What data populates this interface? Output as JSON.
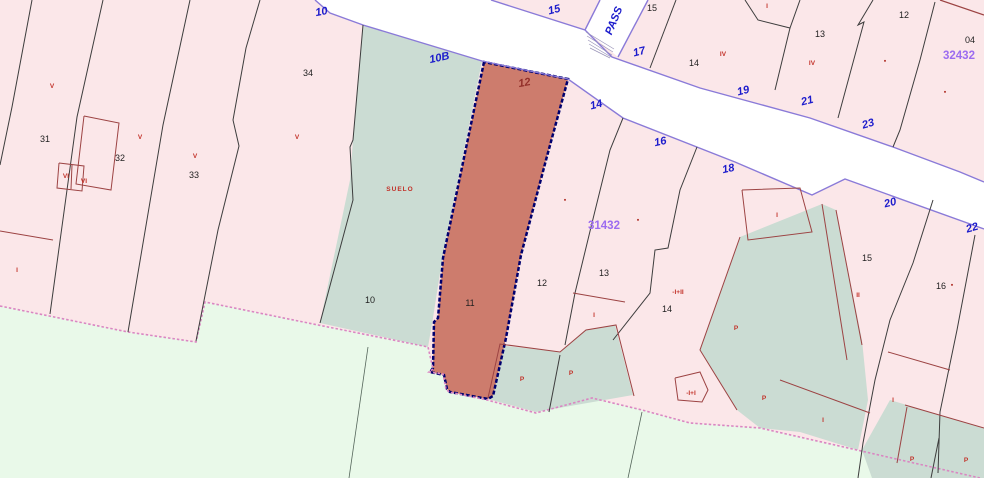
{
  "colors": {
    "pink": "#fbe7e9",
    "rural": "#e9f9e9",
    "teal": "#cbdcd3",
    "street": "#ffffff",
    "selected": "#cd7c6d",
    "navy": "#00006e",
    "violet": "#8a7ad8",
    "blackline": "#3d3d3d",
    "redline": "#9c4343",
    "urbanedge": "#da86c2",
    "stairs": "#9a94b8",
    "ruralline": "#54655a"
  },
  "map": {
    "width": 984,
    "height": 478,
    "polygons": [
      {
        "name": "urban-base",
        "fill": "pink",
        "points": "0,0 984,0 984,478 0,478"
      },
      {
        "name": "rural-land",
        "fill": "rural",
        "points": "0,306 128,332 196,342 205,302 318,325 428,347 433,369 429,372 443,374 446,389 449,392 487,400 536,413 592,398 642,410 690,423 760,428 980,478 0,478"
      },
      {
        "name": "parcel-10-suelo",
        "fill": "teal",
        "points": "363,25 482,61 442,260 433,318 428,347 320,323 350,180 356,100"
      },
      {
        "name": "patio-left",
        "fill": "teal",
        "points": "498,345 560,352 585,330 615,325 633,395 536,412 488,399"
      },
      {
        "name": "patio-14",
        "fill": "teal",
        "points": "740,237 822,204 836,210 862,340 868,400 858,450 800,432 760,428 737,410 700,350"
      },
      {
        "name": "patio-right",
        "fill": "teal",
        "points": "890,400 984,428 984,478 872,478 862,450"
      },
      {
        "name": "street-main",
        "fill": "street",
        "points": "315,0 491,0 585,30 612,57 700,88 810,118 893,147 960,172 984,182 984,229 845,179 812,195 735,162 623,118 568,79 482,61 363,25 330,13"
      },
      {
        "name": "street-passage",
        "fill": "street",
        "points": "600,0 648,0 618,57 585,30"
      },
      {
        "name": "parcel-11-selected",
        "fill": "selected",
        "stroke": "navy",
        "sw": 2.5,
        "dash": "4,2",
        "points": "484,62 443,258 438,318 434,322 433,368 430,372 444,375 447,389 450,392 488,399 493,396 506,338 521,255 546,160 568,79"
      }
    ],
    "lines": [
      {
        "name": "street-border-lower",
        "stroke": "violet",
        "sw": 1.4,
        "points": "315,0 330,13 363,25 482,61 568,79 623,118 735,162 812,195 845,179 984,229"
      },
      {
        "name": "street-border-upper",
        "stroke": "violet",
        "sw": 1.4,
        "points": "491,0 585,30 612,57 700,88 810,118 893,147 960,172 984,182"
      },
      {
        "name": "passage-border-left",
        "stroke": "violet",
        "sw": 1.4,
        "points": "600,0 585,30"
      },
      {
        "name": "passage-border-right",
        "stroke": "violet",
        "sw": 1.4,
        "points": "648,0 618,57"
      },
      {
        "name": "urban-edge",
        "stroke": "urbanedge",
        "sw": 1.6,
        "dash": "2.5,2",
        "points": "0,306 128,332 196,342 205,302 318,325 428,347 433,369 429,372 443,374 446,389 449,392 487,400 536,413 592,398 642,410 690,423 760,428 980,478"
      },
      {
        "name": "parcel-line-31",
        "stroke": "blackline",
        "sw": 1,
        "points": "32,0 12,107 0,165"
      },
      {
        "name": "parcel-line-31-32",
        "stroke": "blackline",
        "sw": 1,
        "points": "103,0 77,117 50,314"
      },
      {
        "name": "parcel-line-32-33",
        "stroke": "blackline",
        "sw": 1,
        "points": "190,0 163,125 128,332"
      },
      {
        "name": "parcel-line-33-34",
        "stroke": "blackline",
        "sw": 1,
        "points": "260,0 246,48 233,120 239,146 218,230 196,341"
      },
      {
        "name": "parcel-line-34-10",
        "stroke": "blackline",
        "sw": 1,
        "points": "363,25 353,140 350,147 353,200 320,323"
      },
      {
        "name": "parcel-line-12-13",
        "stroke": "blackline",
        "sw": 1,
        "points": "623,118 610,150 592,223 575,293 565,345"
      },
      {
        "name": "parcel-line-13-14",
        "stroke": "blackline",
        "sw": 1,
        "points": "697,147 680,190 668,248 655,250 650,293 613,340"
      },
      {
        "name": "patio-divider",
        "stroke": "blackline",
        "sw": 1,
        "points": "560,355 549,412"
      },
      {
        "name": "upper-parcel-line-15-17",
        "stroke": "blackline",
        "sw": 1,
        "points": "676,0 650,68"
      },
      {
        "name": "upper-parcel-small-i",
        "stroke": "blackline",
        "sw": 1,
        "points": "745,0 758,20 790,28 800,0"
      },
      {
        "name": "upper-parcel-line-14-13",
        "stroke": "blackline",
        "sw": 1,
        "points": "790,28 775,90"
      },
      {
        "name": "upper-parcel-line-13-12",
        "stroke": "blackline",
        "sw": 1,
        "points": "873,0 858,25 864,22 838,118"
      },
      {
        "name": "upper-parcel-line-12-04",
        "stroke": "blackline",
        "sw": 1,
        "points": "935,2 920,60 900,130 893,147"
      },
      {
        "name": "right-parcel-line-15-16",
        "stroke": "blackline",
        "sw": 1,
        "points": "933,200 913,263 890,320 875,380 863,443 858,478"
      },
      {
        "name": "right-parcel-line-16-e",
        "stroke": "blackline",
        "sw": 1,
        "points": "975,235 957,330 940,412 938,473"
      },
      {
        "name": "right-patio-divider",
        "stroke": "blackline",
        "sw": 1,
        "points": "939,438 931,478"
      },
      {
        "name": "rural-line-1",
        "stroke": "ruralline",
        "sw": 0.8,
        "points": "368,347 349,478"
      },
      {
        "name": "rural-line-2",
        "stroke": "ruralline",
        "sw": 0.8,
        "points": "642,412 628,478"
      },
      {
        "name": "building-edge-left",
        "stroke": "redline",
        "sw": 1,
        "points": "0,231 53,240"
      },
      {
        "name": "building-32-outline",
        "stroke": "redline",
        "sw": 1,
        "points": "84,116 119,123 111,190 76,184 84,116"
      },
      {
        "name": "building-32-annex",
        "stroke": "redline",
        "sw": 1,
        "points": "59,163 84,166 82,191 57,188 59,163"
      },
      {
        "name": "building-32-annex-div",
        "stroke": "redline",
        "sw": 1,
        "points": "72,165 71,189"
      },
      {
        "name": "building-line-13-i",
        "stroke": "redline",
        "sw": 1,
        "points": "573,293 625,302"
      },
      {
        "name": "building-i-i-outline",
        "stroke": "redline",
        "sw": 1,
        "points": "675,378 700,372 708,390 702,402 678,400 675,378"
      },
      {
        "name": "patio-14-border",
        "stroke": "redline",
        "sw": 1,
        "points": "740,237 700,350 737,410"
      },
      {
        "name": "strip-border-left",
        "stroke": "redline",
        "sw": 1,
        "points": "822,204 847,360"
      },
      {
        "name": "strip-border-right",
        "stroke": "redline",
        "sw": 1,
        "points": "836,210 862,345"
      },
      {
        "name": "building-i-strip-outline",
        "stroke": "redline",
        "sw": 1,
        "points": "742,190 800,188 812,232 748,240 742,190"
      },
      {
        "name": "building-line-right-1",
        "stroke": "redline",
        "sw": 1,
        "points": "780,380 870,413"
      },
      {
        "name": "building-line-right-2",
        "stroke": "redline",
        "sw": 1,
        "points": "888,352 950,370"
      },
      {
        "name": "right-patio-border",
        "stroke": "redline",
        "sw": 1,
        "points": "905,405 984,428"
      },
      {
        "name": "right-patio-border-2",
        "stroke": "redline",
        "sw": 1,
        "points": "907,407 897,463"
      },
      {
        "name": "patio-left-border",
        "stroke": "redline",
        "sw": 1,
        "points": "488,398 500,344 560,352 586,330 616,325 634,396"
      },
      {
        "name": "building-corner-topright",
        "stroke": "redline",
        "sw": 1.2,
        "points": "940,0 984,15"
      },
      {
        "name": "stair-1",
        "stroke": "stairs",
        "sw": 0.7,
        "points": "586,32 614,49"
      },
      {
        "name": "stair-2",
        "stroke": "stairs",
        "sw": 0.7,
        "points": "587,36 613,52"
      },
      {
        "name": "stair-3",
        "stroke": "stairs",
        "sw": 0.7,
        "points": "588,40 612,55"
      },
      {
        "name": "stair-4",
        "stroke": "stairs",
        "sw": 0.7,
        "points": "589,44 611,57"
      },
      {
        "name": "stair-5",
        "stroke": "stairs",
        "sw": 0.7,
        "points": "590,48 610,58"
      }
    ],
    "labels": [
      {
        "text": "10",
        "x": 322,
        "y": 15,
        "cls": "lbl-blue",
        "rot": -10,
        "name": "street-number-10"
      },
      {
        "text": "15",
        "x": 555,
        "y": 13,
        "cls": "lbl-blue",
        "rot": -14,
        "name": "street-number-15"
      },
      {
        "text": "10B",
        "x": 440,
        "y": 61,
        "cls": "lbl-blue",
        "rot": -12,
        "name": "street-number-10b"
      },
      {
        "text": "14",
        "x": 597,
        "y": 108,
        "cls": "lbl-blue",
        "rot": -14,
        "name": "street-number-14"
      },
      {
        "text": "17",
        "x": 640,
        "y": 55,
        "cls": "lbl-blue",
        "rot": -14,
        "name": "street-number-17"
      },
      {
        "text": "16",
        "x": 661,
        "y": 145,
        "cls": "lbl-blue",
        "rot": -12,
        "name": "street-number-16"
      },
      {
        "text": "18",
        "x": 729,
        "y": 172,
        "cls": "lbl-blue",
        "rot": -12,
        "name": "street-number-18"
      },
      {
        "text": "19",
        "x": 744,
        "y": 94,
        "cls": "lbl-blue",
        "rot": -14,
        "name": "street-number-19"
      },
      {
        "text": "21",
        "x": 808,
        "y": 104,
        "cls": "lbl-blue",
        "rot": -14,
        "name": "street-number-21"
      },
      {
        "text": "23",
        "x": 869,
        "y": 127,
        "cls": "lbl-blue",
        "rot": -16,
        "name": "street-number-23"
      },
      {
        "text": "20",
        "x": 891,
        "y": 206,
        "cls": "lbl-blue",
        "rot": -14,
        "name": "street-number-20"
      },
      {
        "text": "22",
        "x": 973,
        "y": 231,
        "cls": "lbl-blue",
        "rot": -16,
        "name": "street-number-22"
      },
      {
        "text": "PASS",
        "x": 617,
        "y": 22,
        "cls": "lbl-blue",
        "rot": -68,
        "name": "street-name-pass"
      },
      {
        "text": "12",
        "x": 525,
        "y": 86,
        "cls": "lbl-maroon",
        "rot": -10,
        "name": "street-number-12-selected"
      },
      {
        "text": "31",
        "x": 45,
        "y": 142,
        "cls": "lbl-black",
        "name": "parcel-number-31"
      },
      {
        "text": "32",
        "x": 120,
        "y": 161,
        "cls": "lbl-black",
        "name": "parcel-number-32"
      },
      {
        "text": "33",
        "x": 194,
        "y": 178,
        "cls": "lbl-black",
        "name": "parcel-number-33"
      },
      {
        "text": "34",
        "x": 308,
        "y": 76,
        "cls": "lbl-black",
        "name": "parcel-number-34"
      },
      {
        "text": "10",
        "x": 370,
        "y": 303,
        "cls": "lbl-black",
        "name": "parcel-number-10"
      },
      {
        "text": "11",
        "x": 470,
        "y": 306,
        "cls": "lbl-black",
        "name": "parcel-number-11"
      },
      {
        "text": "12",
        "x": 542,
        "y": 286,
        "cls": "lbl-black",
        "name": "parcel-number-12"
      },
      {
        "text": "13",
        "x": 604,
        "y": 276,
        "cls": "lbl-black",
        "name": "parcel-number-13"
      },
      {
        "text": "14",
        "x": 667,
        "y": 312,
        "cls": "lbl-black",
        "name": "parcel-number-14"
      },
      {
        "text": "15",
        "x": 652,
        "y": 11,
        "cls": "lbl-black",
        "name": "parcel-number-15-upper"
      },
      {
        "text": "14",
        "x": 694,
        "y": 66,
        "cls": "lbl-black",
        "name": "parcel-number-14-upper"
      },
      {
        "text": "13",
        "x": 820,
        "y": 37,
        "cls": "lbl-black",
        "name": "parcel-number-13-upper"
      },
      {
        "text": "12",
        "x": 904,
        "y": 18,
        "cls": "lbl-black",
        "name": "parcel-number-12-upper"
      },
      {
        "text": "04",
        "x": 970,
        "y": 43,
        "cls": "lbl-black",
        "name": "parcel-number-04"
      },
      {
        "text": "15",
        "x": 867,
        "y": 261,
        "cls": "lbl-black",
        "name": "parcel-number-15-right"
      },
      {
        "text": "16",
        "x": 941,
        "y": 289,
        "cls": "lbl-black",
        "name": "parcel-number-16-right"
      },
      {
        "text": "31432",
        "x": 604,
        "y": 229,
        "cls": "lbl-purple",
        "name": "block-number-31432"
      },
      {
        "text": "32432",
        "x": 959,
        "y": 59,
        "cls": "lbl-purple",
        "name": "block-number-32432"
      },
      {
        "text": "V",
        "x": 52,
        "y": 88,
        "cls": "lbl-red",
        "name": "floors-v-1"
      },
      {
        "text": "V",
        "x": 140,
        "y": 139,
        "cls": "lbl-red",
        "name": "floors-v-2"
      },
      {
        "text": "V",
        "x": 195,
        "y": 158,
        "cls": "lbl-red",
        "name": "floors-v-3"
      },
      {
        "text": "V",
        "x": 297,
        "y": 139,
        "cls": "lbl-red",
        "name": "floors-v-4"
      },
      {
        "text": "VI",
        "x": 66,
        "y": 178,
        "cls": "lbl-red",
        "name": "floors-vi-1"
      },
      {
        "text": "VI",
        "x": 84,
        "y": 183,
        "cls": "lbl-red",
        "name": "floors-vi-2"
      },
      {
        "text": "I",
        "x": 17,
        "y": 272,
        "cls": "lbl-red",
        "name": "floors-i-left"
      },
      {
        "text": "I",
        "x": 767,
        "y": 8,
        "cls": "lbl-red",
        "name": "floors-i-upper"
      },
      {
        "text": "IV",
        "x": 723,
        "y": 56,
        "cls": "lbl-red",
        "name": "floors-iv-1"
      },
      {
        "text": "IV",
        "x": 812,
        "y": 65,
        "cls": "lbl-red",
        "name": "floors-iv-2"
      },
      {
        "text": "I",
        "x": 777,
        "y": 217,
        "cls": "lbl-red",
        "name": "floors-i-strip"
      },
      {
        "text": "I",
        "x": 594,
        "y": 317,
        "cls": "lbl-red",
        "name": "floors-i-center"
      },
      {
        "text": "-I+II",
        "x": 678,
        "y": 294,
        "cls": "lbl-red",
        "name": "floors-minus-i-plus-ii"
      },
      {
        "text": "-I+I",
        "x": 691,
        "y": 395,
        "cls": "lbl-red",
        "name": "floors-minus-i-plus-i"
      },
      {
        "text": "II",
        "x": 858,
        "y": 297,
        "cls": "lbl-red",
        "name": "floors-ii-right"
      },
      {
        "text": "I",
        "x": 823,
        "y": 422,
        "cls": "lbl-red",
        "name": "floors-i-right-1"
      },
      {
        "text": "I",
        "x": 893,
        "y": 402,
        "cls": "lbl-red",
        "name": "floors-i-right-2"
      },
      {
        "text": "SUELO",
        "x": 400,
        "y": 191,
        "cls": "lbl-suelo",
        "name": "suelo-label"
      },
      {
        "text": "P",
        "x": 522,
        "y": 381,
        "cls": "lbl-red",
        "name": "patio-p-1"
      },
      {
        "text": "P",
        "x": 571,
        "y": 375,
        "cls": "lbl-red",
        "name": "patio-p-2"
      },
      {
        "text": "P",
        "x": 736,
        "y": 330,
        "cls": "lbl-red",
        "name": "patio-p-3"
      },
      {
        "text": "P",
        "x": 764,
        "y": 400,
        "cls": "lbl-red",
        "name": "patio-p-4"
      },
      {
        "text": "P",
        "x": 912,
        "y": 461,
        "cls": "lbl-red",
        "name": "patio-p-5"
      },
      {
        "text": "P",
        "x": 966,
        "y": 462,
        "cls": "lbl-red",
        "name": "patio-p-6"
      },
      {
        "text": "▪",
        "x": 885,
        "y": 63,
        "cls": "lbl-sq",
        "name": "floors-mark-1"
      },
      {
        "text": "▪",
        "x": 945,
        "y": 94,
        "cls": "lbl-sq",
        "name": "floors-mark-2"
      },
      {
        "text": "▪",
        "x": 565,
        "y": 202,
        "cls": "lbl-sq",
        "name": "floors-mark-3"
      },
      {
        "text": "▪",
        "x": 638,
        "y": 222,
        "cls": "lbl-sq",
        "name": "floors-mark-4"
      },
      {
        "text": "▪",
        "x": 952,
        "y": 287,
        "cls": "lbl-sq",
        "name": "floors-mark-5"
      }
    ]
  }
}
